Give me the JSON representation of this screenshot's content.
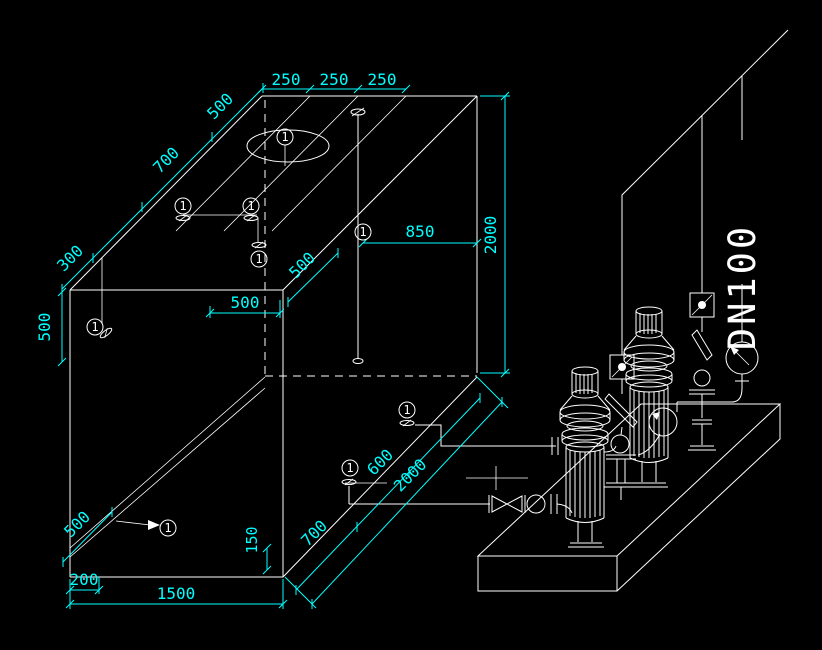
{
  "drawing": {
    "background": "#000000",
    "line_color": "#ffffff",
    "dimension_color": "#00ffff"
  },
  "pipe_label": "DN100",
  "callout": "1",
  "dims": {
    "top_chain": [
      "250",
      "250",
      "250"
    ],
    "top_edge_500": "500",
    "top_edge_700": "700",
    "top_edge_300": "300",
    "left_height_500": "500",
    "front_500": "500",
    "plan_diag_500": "500",
    "inner_pipe_850": "850",
    "tank_height_2000": "2000",
    "drain_500": "500",
    "base_200": "200",
    "base_1500": "1500",
    "outlet_150": "150",
    "bottom_700": "700",
    "bottom_600": "600",
    "bottom_2000": "2000"
  }
}
